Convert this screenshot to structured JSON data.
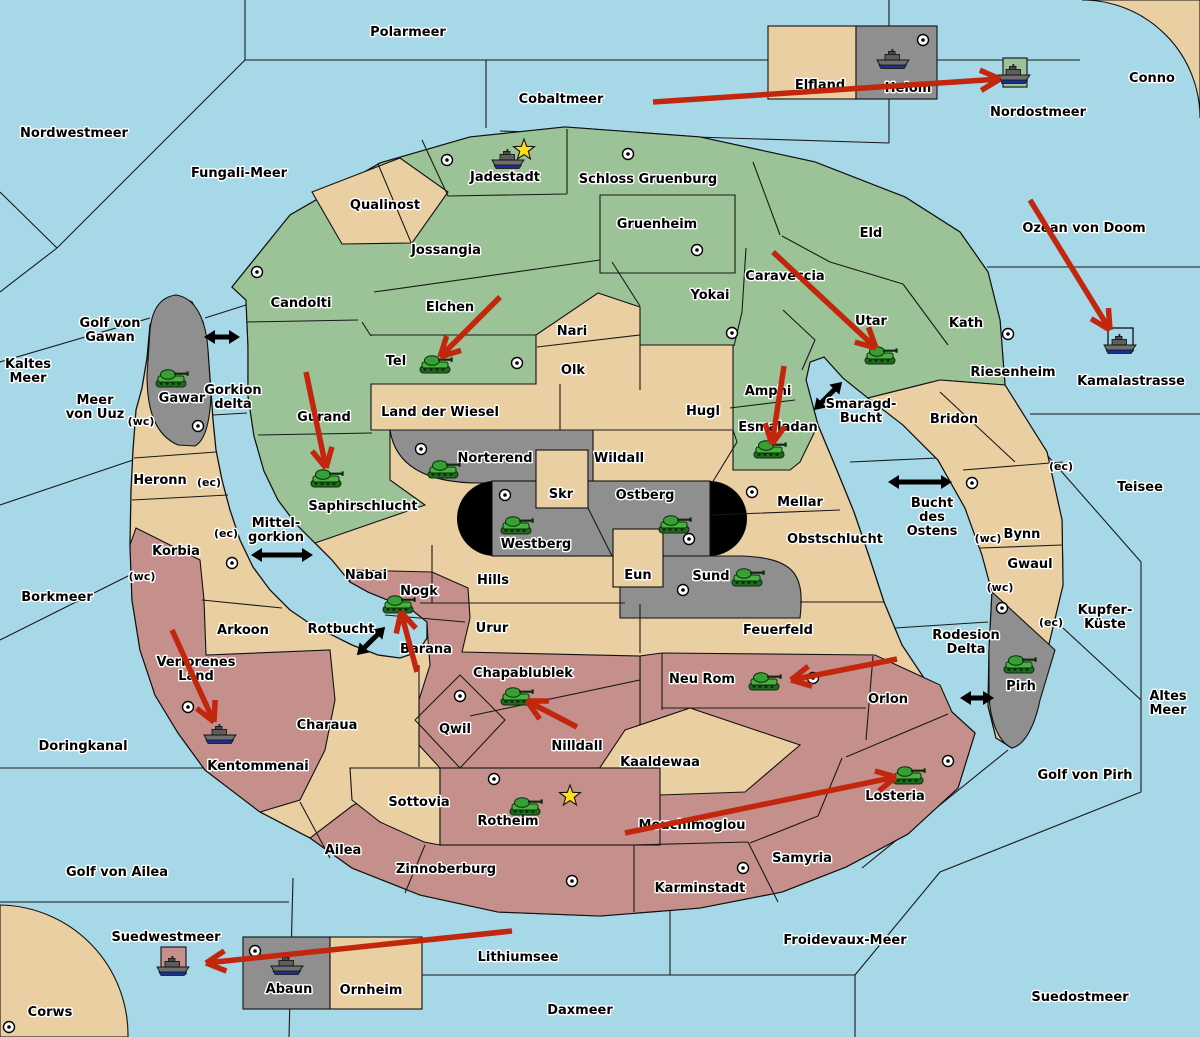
{
  "map": {
    "colors": {
      "sea": "#A7D8E8",
      "land_tan": "#E9CFA2",
      "land_green": "#9CC297",
      "land_rose": "#C5908C",
      "land_gray": "#8F8F8F",
      "capsule_black": "#000000",
      "attack_arrow_red": "#C2270E",
      "ferry_arrow_black": "#000000",
      "star_yellow": "#FFDE1A",
      "label_text": "#000000",
      "label_halo": "#FFFFFF"
    },
    "sea_labels": [
      {
        "t": "Polarmeer",
        "x": 408,
        "y": 36
      },
      {
        "t": "Nordwestmeer",
        "x": 74,
        "y": 137
      },
      {
        "t": "Fungali-Meer",
        "x": 239,
        "y": 177
      },
      {
        "t": "Cobaltmeer",
        "x": 561,
        "y": 103
      },
      {
        "t": "Nordostmeer",
        "x": 1038,
        "y": 116
      },
      {
        "t": "Conno",
        "x": 1152,
        "y": 82
      },
      {
        "t": "Ozean von Doom",
        "x": 1084,
        "y": 232
      },
      {
        "t": "Kamalastrasse",
        "x": 1131,
        "y": 385
      },
      {
        "t": "Teisee",
        "x": 1140,
        "y": 491
      },
      {
        "t": "Kaltes Meer",
        "l": [
          "Kaltes",
          "Meer"
        ],
        "x": 28,
        "y": 368
      },
      {
        "t": "Golf von Gawan",
        "l": [
          "Golf von",
          "Gawan"
        ],
        "x": 110,
        "y": 327
      },
      {
        "t": "Meer von Uuz",
        "l": [
          "Meer",
          "von Uuz"
        ],
        "x": 95,
        "y": 404
      },
      {
        "t": "Gorkion delta",
        "l": [
          "Gorkion",
          "delta"
        ],
        "x": 233,
        "y": 394
      },
      {
        "t": "Mittel-gorkion",
        "l": [
          "Mittel-",
          "gorkion"
        ],
        "x": 276,
        "y": 527
      },
      {
        "t": "Borkmeer",
        "x": 57,
        "y": 601
      },
      {
        "t": "Smaragd-Bucht",
        "l": [
          "Smaragd-",
          "Bucht"
        ],
        "x": 861,
        "y": 408
      },
      {
        "t": "Bucht des Ostens",
        "l": [
          "Bucht",
          "des",
          "Ostens"
        ],
        "x": 932,
        "y": 507
      },
      {
        "t": "Rotbucht",
        "x": 341,
        "y": 633
      },
      {
        "t": "Doringkanal",
        "x": 83,
        "y": 750
      },
      {
        "t": "Golf von Ailea",
        "x": 117,
        "y": 876
      },
      {
        "t": "Rodesion Delta",
        "l": [
          "Rodesion",
          "Delta"
        ],
        "x": 966,
        "y": 639
      },
      {
        "t": "Golf von Pirh",
        "x": 1085,
        "y": 779
      },
      {
        "t": "Altes Meer",
        "l": [
          "Altes",
          "Meer"
        ],
        "x": 1168,
        "y": 700
      },
      {
        "t": "Kupfer-Küste",
        "l": [
          "Kupfer-",
          "Küste"
        ],
        "x": 1105,
        "y": 614
      },
      {
        "t": "Suedwestmeer",
        "x": 166,
        "y": 941
      },
      {
        "t": "Lithiumsee",
        "x": 518,
        "y": 961
      },
      {
        "t": "Daxmeer",
        "x": 580,
        "y": 1014
      },
      {
        "t": "Froidevaux-Meer",
        "x": 845,
        "y": 944
      },
      {
        "t": "Suedostmeer",
        "x": 1080,
        "y": 1001
      },
      {
        "t": "Corws",
        "x": 50,
        "y": 1016
      }
    ],
    "land_labels": [
      {
        "t": "Jadestadt",
        "x": 505,
        "y": 181
      },
      {
        "t": "Schloss Gruenburg",
        "x": 648,
        "y": 183
      },
      {
        "t": "Qualinost",
        "x": 385,
        "y": 209
      },
      {
        "t": "Jossangia",
        "x": 446,
        "y": 254
      },
      {
        "t": "Gruenheim",
        "x": 657,
        "y": 228
      },
      {
        "t": "Eld",
        "x": 871,
        "y": 237
      },
      {
        "t": "Caraveccia",
        "x": 785,
        "y": 280
      },
      {
        "t": "Yokai",
        "x": 710,
        "y": 299
      },
      {
        "t": "Elchen",
        "x": 450,
        "y": 311
      },
      {
        "t": "Utar",
        "x": 871,
        "y": 325
      },
      {
        "t": "Kath",
        "x": 966,
        "y": 327
      },
      {
        "t": "Candolti",
        "x": 301,
        "y": 307
      },
      {
        "t": "Tel",
        "x": 396,
        "y": 365
      },
      {
        "t": "Nari",
        "x": 572,
        "y": 335
      },
      {
        "t": "Olk",
        "x": 573,
        "y": 374
      },
      {
        "t": "Riesenheim",
        "x": 1013,
        "y": 376
      },
      {
        "t": "Amphi",
        "x": 768,
        "y": 395
      },
      {
        "t": "Gawar",
        "x": 182,
        "y": 402
      },
      {
        "t": "Land der Wiesel",
        "x": 440,
        "y": 416
      },
      {
        "t": "Hugl",
        "x": 703,
        "y": 415
      },
      {
        "t": "Esmaladan",
        "x": 778,
        "y": 431
      },
      {
        "t": "Bridon",
        "x": 954,
        "y": 423
      },
      {
        "t": "Gurand",
        "x": 324,
        "y": 421
      },
      {
        "t": "Norterend",
        "x": 495,
        "y": 462
      },
      {
        "t": "Wildall",
        "x": 619,
        "y": 462
      },
      {
        "t": "Saphirschlucht",
        "x": 363,
        "y": 510
      },
      {
        "t": "Skr",
        "x": 561,
        "y": 498
      },
      {
        "t": "Ostberg",
        "x": 645,
        "y": 499
      },
      {
        "t": "Mellar",
        "x": 800,
        "y": 506
      },
      {
        "t": "Heronn",
        "x": 160,
        "y": 484
      },
      {
        "t": "Korbia",
        "x": 176,
        "y": 555
      },
      {
        "t": "Westberg",
        "x": 536,
        "y": 548
      },
      {
        "t": "Obstschlucht",
        "x": 835,
        "y": 543
      },
      {
        "t": "Bynn",
        "x": 1022,
        "y": 538
      },
      {
        "t": "Gwaul",
        "x": 1030,
        "y": 568
      },
      {
        "t": "Nabai",
        "x": 366,
        "y": 579
      },
      {
        "t": "Hills",
        "x": 493,
        "y": 584
      },
      {
        "t": "Eun",
        "x": 638,
        "y": 579
      },
      {
        "t": "Sund",
        "x": 711,
        "y": 580
      },
      {
        "t": "Nogk",
        "x": 419,
        "y": 595
      },
      {
        "t": "Feuerfeld",
        "x": 778,
        "y": 634
      },
      {
        "t": "Urur",
        "x": 492,
        "y": 632
      },
      {
        "t": "Arkoon",
        "x": 243,
        "y": 634
      },
      {
        "t": "Barana",
        "x": 426,
        "y": 653
      },
      {
        "t": "Verlorenes Land",
        "l": [
          "Verlorenes",
          "Land"
        ],
        "x": 196,
        "y": 666
      },
      {
        "t": "Chapablublek",
        "x": 523,
        "y": 677
      },
      {
        "t": "Neu Rom",
        "x": 702,
        "y": 683
      },
      {
        "t": "Orlon",
        "x": 888,
        "y": 703
      },
      {
        "t": "Pirh",
        "x": 1021,
        "y": 690
      },
      {
        "t": "Qwil",
        "x": 455,
        "y": 733
      },
      {
        "t": "Charaua",
        "x": 327,
        "y": 729
      },
      {
        "t": "Nilldall",
        "x": 577,
        "y": 750
      },
      {
        "t": "Kaaldewaa",
        "x": 660,
        "y": 766
      },
      {
        "t": "Kentommenai",
        "x": 258,
        "y": 770
      },
      {
        "t": "Sottovia",
        "x": 419,
        "y": 806
      },
      {
        "t": "Rotheim",
        "x": 508,
        "y": 825
      },
      {
        "t": "Mouchimoglou",
        "x": 692,
        "y": 829
      },
      {
        "t": "Losteria",
        "x": 895,
        "y": 800
      },
      {
        "t": "Ailea",
        "x": 343,
        "y": 854
      },
      {
        "t": "Zinnoberburg",
        "x": 446,
        "y": 873
      },
      {
        "t": "Samyria",
        "x": 802,
        "y": 862
      },
      {
        "t": "Karminstadt",
        "x": 700,
        "y": 892
      },
      {
        "t": "Elfland",
        "x": 820,
        "y": 89
      },
      {
        "t": "Helom",
        "x": 908,
        "y": 92
      },
      {
        "t": "Abaun",
        "x": 289,
        "y": 993
      },
      {
        "t": "Ornheim",
        "x": 371,
        "y": 994
      }
    ],
    "coast_markers": [
      {
        "t": "(wc)",
        "x": 141,
        "y": 425
      },
      {
        "t": "(ec)",
        "x": 209,
        "y": 486
      },
      {
        "t": "(ec)",
        "x": 226,
        "y": 537
      },
      {
        "t": "(wc)",
        "x": 142,
        "y": 580
      },
      {
        "t": "(ec)",
        "x": 1061,
        "y": 470
      },
      {
        "t": "(wc)",
        "x": 988,
        "y": 542
      },
      {
        "t": "(wc)",
        "x": 1000,
        "y": 591
      },
      {
        "t": "(ec)",
        "x": 1051,
        "y": 626
      }
    ],
    "city_dots": [
      [
        447,
        160
      ],
      [
        628,
        154
      ],
      [
        697,
        250
      ],
      [
        923,
        40
      ],
      [
        257,
        272
      ],
      [
        732,
        333
      ],
      [
        1008,
        334
      ],
      [
        517,
        363
      ],
      [
        198,
        426
      ],
      [
        421,
        449
      ],
      [
        972,
        483
      ],
      [
        752,
        492
      ],
      [
        505,
        495
      ],
      [
        689,
        539
      ],
      [
        232,
        563
      ],
      [
        683,
        590
      ],
      [
        1002,
        608
      ],
      [
        460,
        696
      ],
      [
        188,
        707
      ],
      [
        813,
        678
      ],
      [
        948,
        761
      ],
      [
        494,
        779
      ],
      [
        255,
        951
      ],
      [
        743,
        868
      ],
      [
        572,
        881
      ],
      [
        9,
        1027
      ]
    ],
    "tanks": [
      {
        "territory": "Gawar",
        "x": 173,
        "y": 378
      },
      {
        "territory": "Tel",
        "x": 437,
        "y": 364
      },
      {
        "territory": "Utar",
        "x": 882,
        "y": 355
      },
      {
        "territory": "Esmaladan",
        "x": 771,
        "y": 449
      },
      {
        "territory": "Saphirschlucht",
        "x": 328,
        "y": 478
      },
      {
        "territory": "Norterend",
        "x": 445,
        "y": 469
      },
      {
        "territory": "Westberg",
        "x": 518,
        "y": 525
      },
      {
        "territory": "Ostberg",
        "x": 676,
        "y": 524
      },
      {
        "territory": "Sund",
        "x": 749,
        "y": 577
      },
      {
        "territory": "Nogk",
        "x": 400,
        "y": 604
      },
      {
        "territory": "Chapablublek",
        "x": 518,
        "y": 696
      },
      {
        "territory": "Neu Rom",
        "x": 766,
        "y": 681
      },
      {
        "territory": "Losteria",
        "x": 910,
        "y": 775
      },
      {
        "territory": "Rotheim",
        "x": 527,
        "y": 806
      },
      {
        "territory": "Pirh",
        "x": 1021,
        "y": 664
      }
    ],
    "ships": [
      {
        "territory": "Jadestadt",
        "x": 508,
        "y": 160
      },
      {
        "territory": "Helom",
        "x": 893,
        "y": 60
      },
      {
        "territory": "Nordostmeer",
        "x": 1014,
        "y": 75
      },
      {
        "territory": "Kamalastrasse",
        "x": 1120,
        "y": 345
      },
      {
        "territory": "Kentommenai",
        "x": 220,
        "y": 735
      },
      {
        "territory": "Abaun",
        "x": 287,
        "y": 966
      },
      {
        "territory": "Suedwestmeer",
        "x": 173,
        "y": 967
      }
    ],
    "stars": [
      [
        524,
        150
      ],
      [
        570,
        796
      ]
    ],
    "attack_arrows": [
      [
        653,
        102,
        1000,
        79
      ],
      [
        1030,
        200,
        1110,
        330
      ],
      [
        500,
        297,
        440,
        357
      ],
      [
        773,
        252,
        876,
        348
      ],
      [
        784,
        366,
        772,
        444
      ],
      [
        306,
        372,
        326,
        468
      ],
      [
        417,
        672,
        401,
        612
      ],
      [
        577,
        727,
        527,
        701
      ],
      [
        897,
        659,
        791,
        680
      ],
      [
        625,
        833,
        896,
        777
      ],
      [
        512,
        931,
        206,
        963
      ],
      [
        172,
        630,
        214,
        722
      ]
    ],
    "ferry_arrows": [
      [
        222,
        337,
        0,
        36
      ],
      [
        282,
        555,
        0,
        62
      ],
      [
        828,
        396,
        -45,
        40
      ],
      [
        920,
        482,
        0,
        64
      ],
      [
        371,
        641,
        -45,
        40
      ],
      [
        977,
        698,
        0,
        34
      ]
    ]
  }
}
